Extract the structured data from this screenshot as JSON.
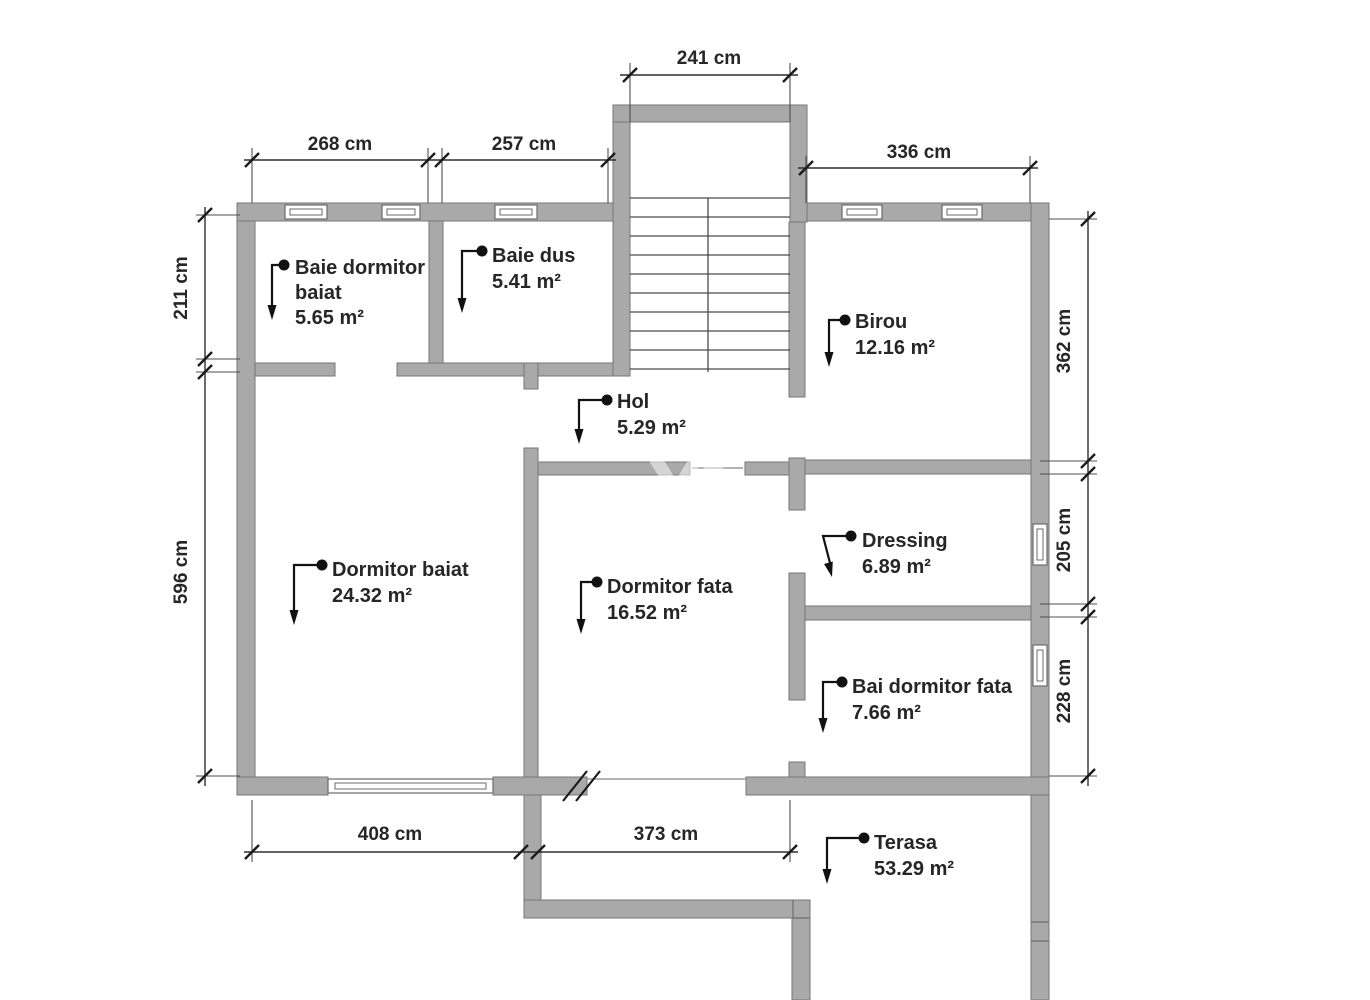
{
  "document": {
    "type": "floor-plan",
    "units": "cm"
  },
  "rooms": [
    {
      "id": "baie-dormitor-baiat",
      "label_lines": [
        "Baie dormitor",
        "baiat"
      ],
      "area": "5.65 m²"
    },
    {
      "id": "baie-dus",
      "label_lines": [
        "Baie dus"
      ],
      "area": "5.41 m²"
    },
    {
      "id": "birou",
      "label_lines": [
        "Birou"
      ],
      "area": "12.16 m²"
    },
    {
      "id": "hol",
      "label_lines": [
        "Hol"
      ],
      "area": "5.29 m²"
    },
    {
      "id": "dormitor-baiat",
      "label_lines": [
        "Dormitor baiat"
      ],
      "area": "24.32 m²"
    },
    {
      "id": "dormitor-fata",
      "label_lines": [
        "Dormitor fata"
      ],
      "area": "16.52 m²"
    },
    {
      "id": "dressing",
      "label_lines": [
        "Dressing"
      ],
      "area": "6.89 m²"
    },
    {
      "id": "bai-dormitor-fata",
      "label_lines": [
        "Bai dormitor fata"
      ],
      "area": "7.66 m²"
    },
    {
      "id": "terasa",
      "label_lines": [
        "Terasa"
      ],
      "area": "53.29 m²"
    }
  ],
  "dimensions": [
    {
      "side": "top",
      "label": "241 cm"
    },
    {
      "side": "top",
      "label": "268 cm"
    },
    {
      "side": "top",
      "label": "257 cm"
    },
    {
      "side": "top",
      "label": "336 cm"
    },
    {
      "side": "left",
      "label": "211 cm"
    },
    {
      "side": "left",
      "label": "596 cm"
    },
    {
      "side": "right",
      "label": "362 cm"
    },
    {
      "side": "right",
      "label": "205 cm"
    },
    {
      "side": "right",
      "label": "228 cm"
    },
    {
      "side": "bottom",
      "label": "408 cm"
    },
    {
      "side": "bottom",
      "label": "373 cm"
    }
  ],
  "colors": {
    "wall_fill": "#a9a9a9",
    "wall_outline": "#767676",
    "dimension_line": "#2f2f2f",
    "label_text": "#262626",
    "background": "#ffffff"
  }
}
